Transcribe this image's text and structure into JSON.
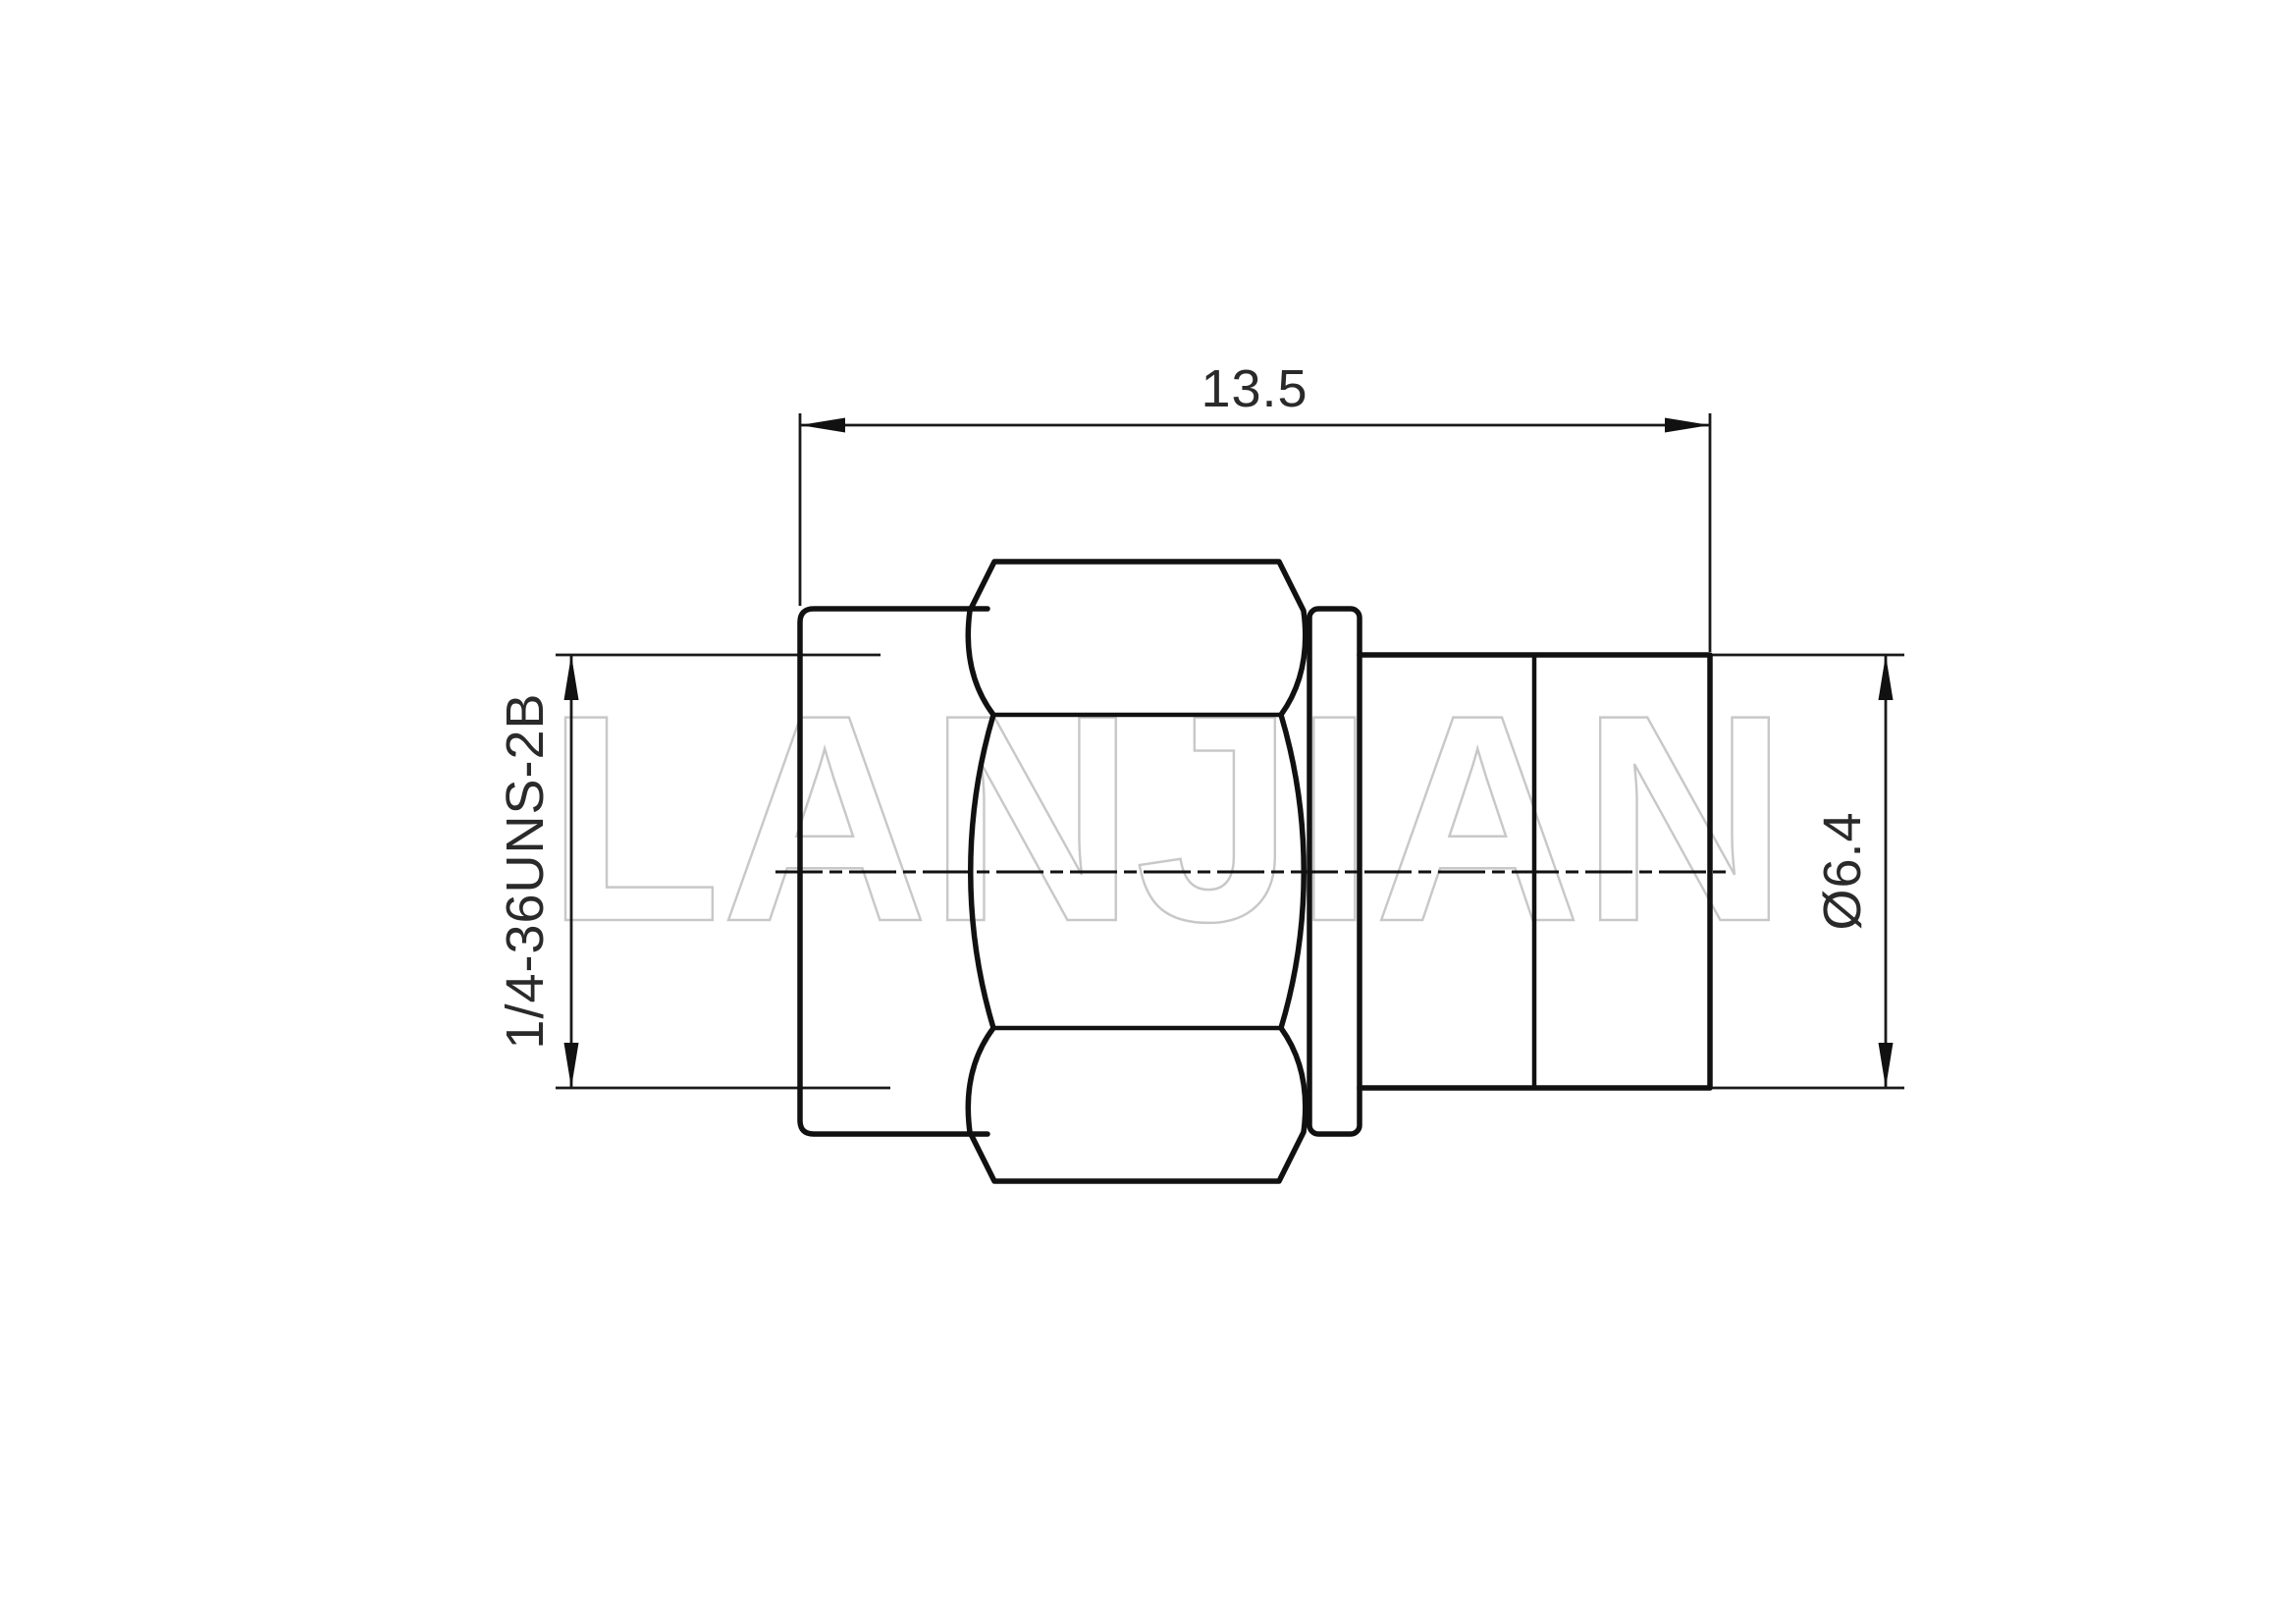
{
  "drawing": {
    "type": "engineering-drawing",
    "view": "connector-side-view",
    "dimensions": {
      "overall_length": {
        "value": "13.5"
      },
      "thread": {
        "value": "1/4-36UNS-2B"
      },
      "body_diameter": {
        "value": "Ø6.4"
      }
    },
    "watermark": {
      "text": "LANJIAN"
    },
    "colors": {
      "background": "#ffffff",
      "line": "#111111",
      "dimension_line": "#1a1a1a",
      "text": "#2a2a2a",
      "watermark": "#c8c8c8"
    }
  }
}
